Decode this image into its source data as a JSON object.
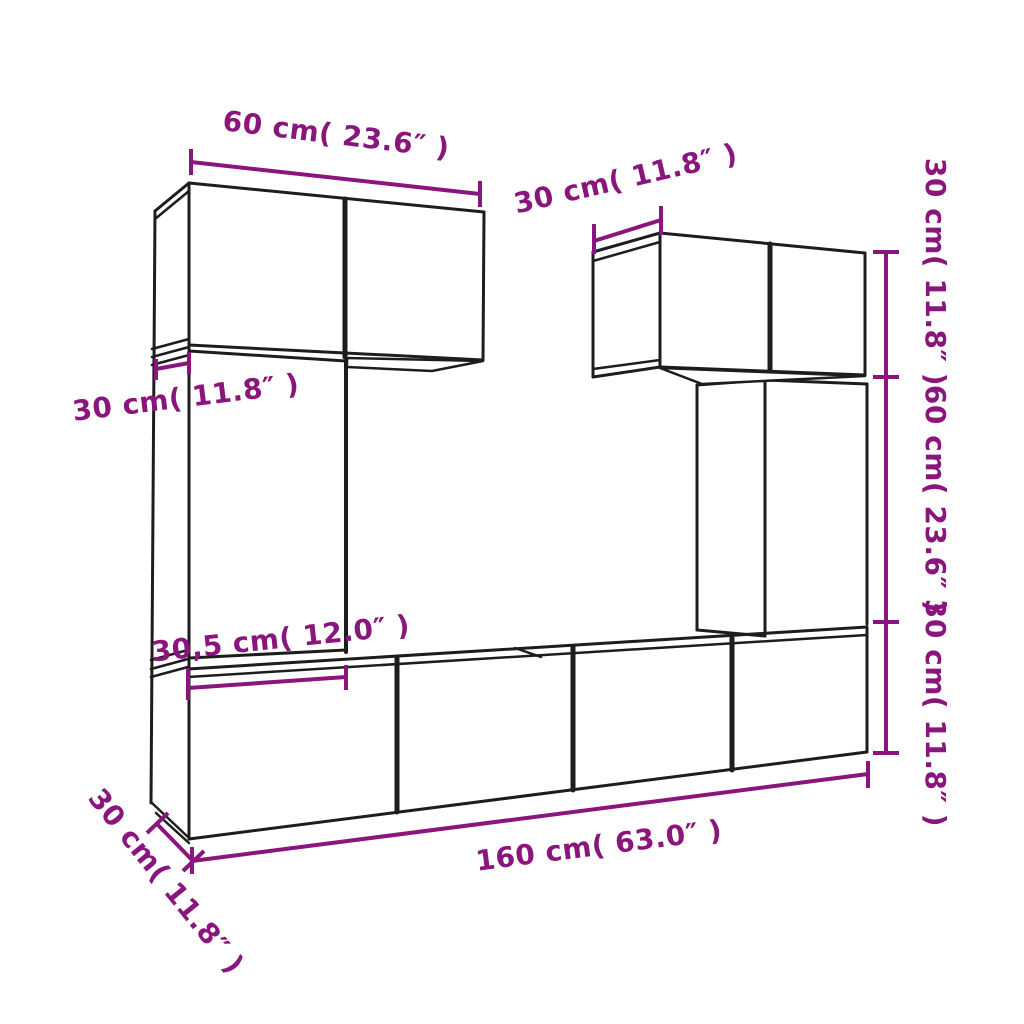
{
  "diagram": {
    "title": "tv-wall-cabinet-set-dimension-diagram",
    "background_color": "#ffffff",
    "outline_color": "#1d1d1d",
    "dimension_color": "#8A157C",
    "measurements": [
      "60 cm( 23.6″ )",
      "30 cm( 11.8″ )",
      "30 cm( 11.8″ )",
      "60 cm( 23.6″ )",
      "30 cm( 11.8″ )",
      "30 cm( 11.8″ )",
      "30,5 cm( 12.0″ )",
      "160 cm( 63.0″ )",
      "30 cm( 11.8″ )"
    ],
    "labels": [
      {
        "name": "dim-label-top-60cm",
        "text": "60 cm( 23.6″  )",
        "x": 336,
        "y": 136,
        "rotate": 7
      },
      {
        "name": "dim-label-topright-30cm",
        "text": "30 cm( 11.8″  )",
        "x": 626,
        "y": 180,
        "rotate": -13
      },
      {
        "name": "dim-label-right-30cm-top",
        "text": "30 cm( 11.8″  )",
        "x": 934,
        "y": 272,
        "rotate": 90
      },
      {
        "name": "dim-label-right-60cm",
        "text": "60 cm( 23.6″  )",
        "x": 934,
        "y": 499,
        "rotate": 90
      },
      {
        "name": "dim-label-right-30cm-bottom",
        "text": "30 cm( 11.8″  )",
        "x": 934,
        "y": 713,
        "rotate": 90
      },
      {
        "name": "dim-label-left-30cm",
        "text": "30 cm( 11.8″  )",
        "x": 186,
        "y": 399,
        "rotate": -7
      },
      {
        "name": "dim-label-width-305cm",
        "text": "30,5 cm( 12.0″  )",
        "x": 281,
        "y": 640,
        "rotate": -6
      },
      {
        "name": "dim-label-bottom-160cm",
        "text": "160 cm( 63.0″  )",
        "x": 599,
        "y": 847,
        "rotate": -7.3
      },
      {
        "name": "dim-label-bottomleft-30cm",
        "text": "30 cm( 11.8″  )",
        "x": 165,
        "y": 882,
        "rotate": 51
      }
    ],
    "dimension_lines": [
      {
        "name": "dim-line-top-60cm",
        "x1": 191,
        "y1": 162,
        "x2": 480,
        "y2": 194
      },
      {
        "name": "dim-line-topright-30cm",
        "x1": 594,
        "y1": 241,
        "x2": 661,
        "y2": 220
      },
      {
        "name": "dim-line-right-heights",
        "x1": 886,
        "y1": 252,
        "x2": 886,
        "y2": 753
      },
      {
        "name": "dim-line-left-30cm",
        "x1": 156,
        "y1": 369,
        "x2": 189,
        "y2": 363
      },
      {
        "name": "dim-line-width-305cm",
        "x1": 188,
        "y1": 688,
        "x2": 346,
        "y2": 677
      },
      {
        "name": "dim-line-bottom-160cm",
        "x1": 192,
        "y1": 861,
        "x2": 868,
        "y2": 774
      },
      {
        "name": "dim-line-bottomleft-30cm",
        "x1": 157,
        "y1": 824,
        "x2": 193,
        "y2": 861
      }
    ],
    "dimension_ticks": [
      {
        "x1": 191,
        "y1": 149,
        "x2": 191,
        "y2": 175
      },
      {
        "x1": 480,
        "y1": 181,
        "x2": 480,
        "y2": 207
      },
      {
        "x1": 594,
        "y1": 224,
        "x2": 594,
        "y2": 254
      },
      {
        "x1": 661,
        "y1": 206,
        "x2": 661,
        "y2": 235
      },
      {
        "x1": 873,
        "y1": 252,
        "x2": 899,
        "y2": 252
      },
      {
        "x1": 873,
        "y1": 377,
        "x2": 899,
        "y2": 377
      },
      {
        "x1": 873,
        "y1": 622,
        "x2": 899,
        "y2": 622
      },
      {
        "x1": 873,
        "y1": 753,
        "x2": 899,
        "y2": 753
      },
      {
        "x1": 156,
        "y1": 359,
        "x2": 156,
        "y2": 380
      },
      {
        "x1": 189,
        "y1": 352,
        "x2": 189,
        "y2": 374
      },
      {
        "x1": 188,
        "y1": 668,
        "x2": 188,
        "y2": 700
      },
      {
        "x1": 346,
        "y1": 665,
        "x2": 346,
        "y2": 690
      },
      {
        "x1": 192,
        "y1": 847,
        "x2": 192,
        "y2": 874
      },
      {
        "x1": 868,
        "y1": 761,
        "x2": 868,
        "y2": 788
      },
      {
        "x1": 147,
        "y1": 833,
        "x2": 168,
        "y2": 813
      },
      {
        "x1": 183,
        "y1": 871,
        "x2": 204,
        "y2": 851
      }
    ],
    "outline_segments": [
      {
        "x1": 189,
        "y1": 183,
        "x2": 484,
        "y2": 212,
        "w": 3
      },
      {
        "x1": 189,
        "y1": 183,
        "x2": 189,
        "y2": 839,
        "w": 3
      },
      {
        "x1": 345,
        "y1": 199,
        "x2": 345,
        "y2": 357,
        "w": 5
      },
      {
        "x1": 484,
        "y1": 212,
        "x2": 483,
        "y2": 360,
        "w": 3
      },
      {
        "x1": 189,
        "y1": 345,
        "x2": 483,
        "y2": 360,
        "w": 3
      },
      {
        "x1": 155,
        "y1": 211,
        "x2": 189,
        "y2": 183,
        "w": 3
      },
      {
        "x1": 155,
        "y1": 219,
        "x2": 189,
        "y2": 191,
        "w": 2.5
      },
      {
        "x1": 155,
        "y1": 211,
        "x2": 151,
        "y2": 803,
        "w": 3
      },
      {
        "x1": 152,
        "y1": 349,
        "x2": 189,
        "y2": 339,
        "w": 2.5
      },
      {
        "x1": 152,
        "y1": 357,
        "x2": 189,
        "y2": 347,
        "w": 2.5
      },
      {
        "x1": 152,
        "y1": 365,
        "x2": 189,
        "y2": 355,
        "w": 2.5
      },
      {
        "x1": 189,
        "y1": 351,
        "x2": 346,
        "y2": 361,
        "w": 3
      },
      {
        "x1": 346,
        "y1": 361,
        "x2": 346,
        "y2": 652,
        "w": 4
      },
      {
        "x1": 189,
        "y1": 658,
        "x2": 346,
        "y2": 650,
        "w": 3
      },
      {
        "x1": 151,
        "y1": 660,
        "x2": 188,
        "y2": 650,
        "w": 2.5
      },
      {
        "x1": 151,
        "y1": 669,
        "x2": 188,
        "y2": 659,
        "w": 2.5
      },
      {
        "x1": 151,
        "y1": 677,
        "x2": 188,
        "y2": 667,
        "w": 2.5
      },
      {
        "x1": 188,
        "y1": 669,
        "x2": 867,
        "y2": 627,
        "w": 3
      },
      {
        "x1": 188,
        "y1": 677,
        "x2": 867,
        "y2": 635,
        "w": 2.5
      },
      {
        "x1": 515,
        "y1": 648,
        "x2": 541,
        "y2": 657,
        "w": 2.5
      },
      {
        "x1": 397,
        "y1": 658,
        "x2": 397,
        "y2": 812,
        "w": 5
      },
      {
        "x1": 573,
        "y1": 647,
        "x2": 573,
        "y2": 790,
        "w": 5
      },
      {
        "x1": 732,
        "y1": 638,
        "x2": 732,
        "y2": 770,
        "w": 5
      },
      {
        "x1": 867,
        "y1": 627,
        "x2": 867,
        "y2": 752,
        "w": 3
      },
      {
        "x1": 189,
        "y1": 839,
        "x2": 867,
        "y2": 752,
        "w": 3
      },
      {
        "x1": 152,
        "y1": 803,
        "x2": 189,
        "y2": 838,
        "w": 2.5
      },
      {
        "x1": 156,
        "y1": 813,
        "x2": 189,
        "y2": 843,
        "w": 2.5
      },
      {
        "x1": 593,
        "y1": 252,
        "x2": 660,
        "y2": 233,
        "w": 3
      },
      {
        "x1": 593,
        "y1": 261,
        "x2": 660,
        "y2": 242,
        "w": 2.5
      },
      {
        "x1": 593,
        "y1": 252,
        "x2": 593,
        "y2": 377,
        "w": 3
      },
      {
        "x1": 593,
        "y1": 369,
        "x2": 660,
        "y2": 360,
        "w": 2.5
      },
      {
        "x1": 593,
        "y1": 377,
        "x2": 660,
        "y2": 367,
        "w": 3
      },
      {
        "x1": 660,
        "y1": 233,
        "x2": 865,
        "y2": 253,
        "w": 3
      },
      {
        "x1": 660,
        "y1": 233,
        "x2": 660,
        "y2": 367,
        "w": 3
      },
      {
        "x1": 770,
        "y1": 244,
        "x2": 770,
        "y2": 371,
        "w": 5
      },
      {
        "x1": 865,
        "y1": 253,
        "x2": 865,
        "y2": 375,
        "w": 3
      },
      {
        "x1": 660,
        "y1": 367,
        "x2": 865,
        "y2": 375,
        "w": 3
      },
      {
        "x1": 697,
        "y1": 385,
        "x2": 697,
        "y2": 630,
        "w": 3
      },
      {
        "x1": 697,
        "y1": 385,
        "x2": 765,
        "y2": 380,
        "w": 3
      },
      {
        "x1": 697,
        "y1": 630,
        "x2": 765,
        "y2": 636,
        "w": 3
      },
      {
        "x1": 765,
        "y1": 380,
        "x2": 765,
        "y2": 636,
        "w": 3
      },
      {
        "x1": 765,
        "y1": 380,
        "x2": 867,
        "y2": 384,
        "w": 3
      },
      {
        "x1": 867,
        "y1": 384,
        "x2": 867,
        "y2": 624,
        "w": 3
      }
    ],
    "underside_polygons": [
      {
        "name": "underside-left-cabinet",
        "points": "347,358 483,361 432,371 347,367"
      },
      {
        "name": "underside-right-cabinet",
        "points": "660,368 865,376 702,384"
      }
    ]
  }
}
